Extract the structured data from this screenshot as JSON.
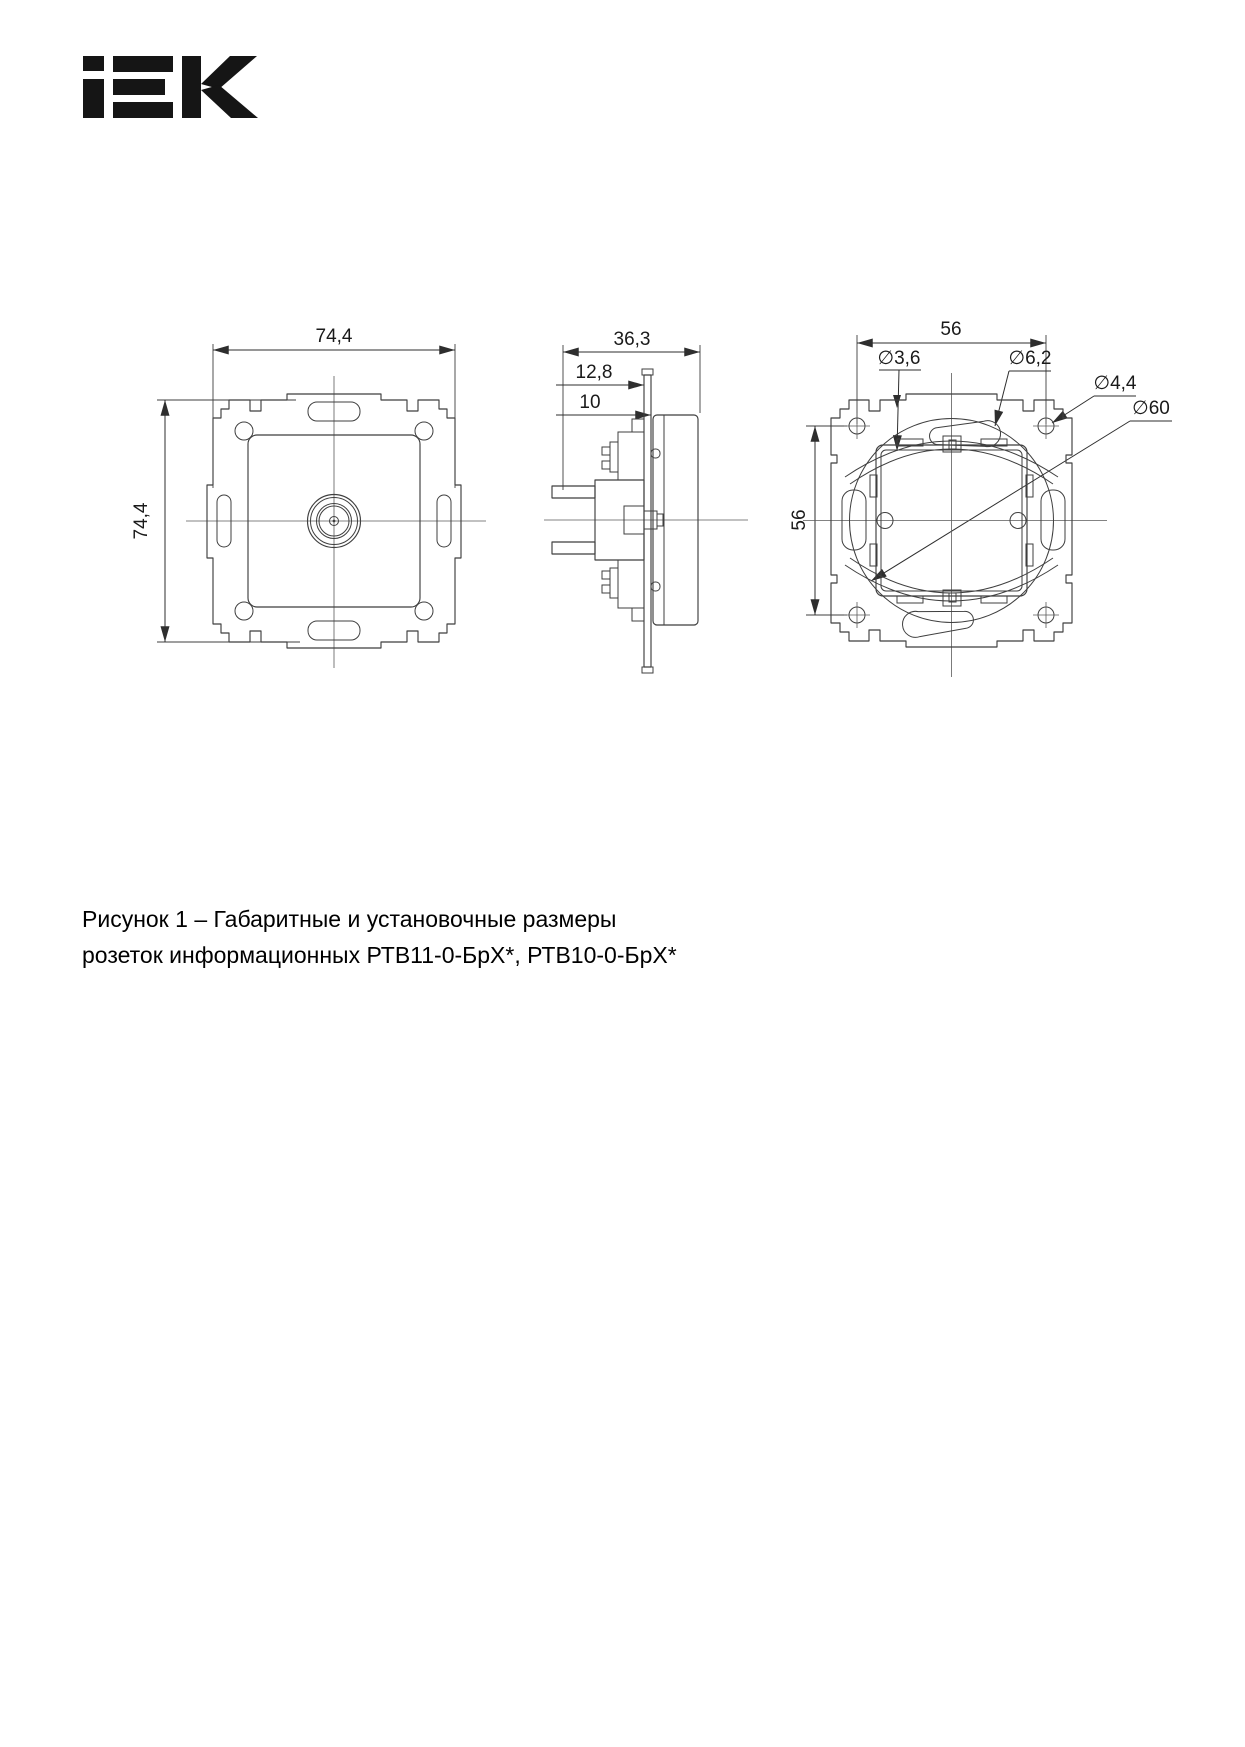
{
  "brand": {
    "name": "IEK"
  },
  "figure": {
    "caption_line1": "Рисунок 1 – Габаритные и установочные размеры",
    "caption_line2": "розеток информационных РТВ11-0-БрХ*, РТВ10-0-БрХ*"
  },
  "views": {
    "front": {
      "dim_width_mm": "74,4",
      "dim_height_mm": "74,4"
    },
    "side": {
      "dim_depth_total_mm": "36,3",
      "dim_depth_mid_mm": "12,8",
      "dim_depth_front_mm": "10"
    },
    "rear": {
      "dim_hole_spacing_h_mm": "56",
      "dim_hole_spacing_v_mm": "56",
      "dia_hole_small": "∅3,6",
      "dia_slot_end": "∅6,2",
      "dia_screw_hole": "∅4,4",
      "dia_mounting_ring": "∅60"
    }
  },
  "colors": {
    "line": "#3f3f3f",
    "centerline": "#5a5a5a",
    "text": "#1a1a1a",
    "background": "#ffffff"
  }
}
